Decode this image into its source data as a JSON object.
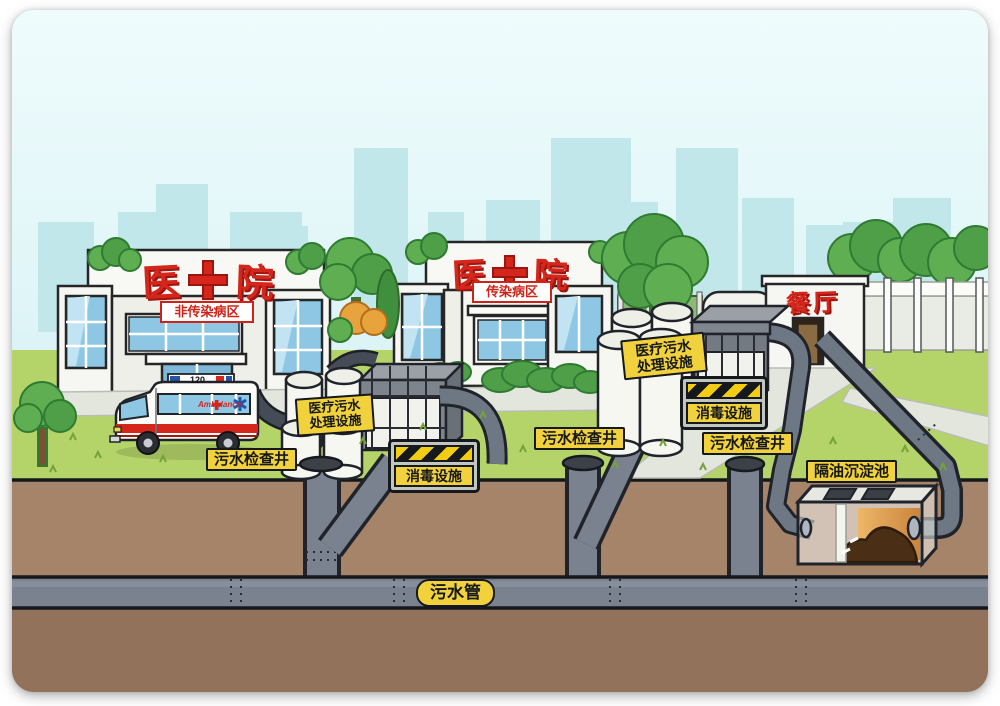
{
  "signs": {
    "hospital": {
      "char_left": "医",
      "char_right": "院"
    },
    "ward_left": "非传染病区",
    "ward_mid": "传染病区",
    "canteen": "餐厅"
  },
  "labels": {
    "treatment_line1": "医疗污水",
    "treatment_line2": "处理设施",
    "disinfection": "消毒设施",
    "inspection_well": "污水检查井",
    "oil_separation_tank": "隔油沉淀池",
    "sewage_pipe": "污水管"
  },
  "ambulance": {
    "number": "120",
    "side_text": "Ambulance"
  },
  "colors": {
    "sky": "#def4f6",
    "skyline": "#bfe6ea",
    "grass": "#b4d469",
    "soil": "#a5846a",
    "soil_dark": "#92725a",
    "pipe": "#79828e",
    "pipe_outline": "#20242a",
    "label_bg": "#f2d23c",
    "hazard_yellow": "#f2cd13",
    "sign_red": "#d5261c",
    "building": "#f6f6f2",
    "window_blue": "#8ec7e4",
    "tree_green": "#5fae52"
  }
}
